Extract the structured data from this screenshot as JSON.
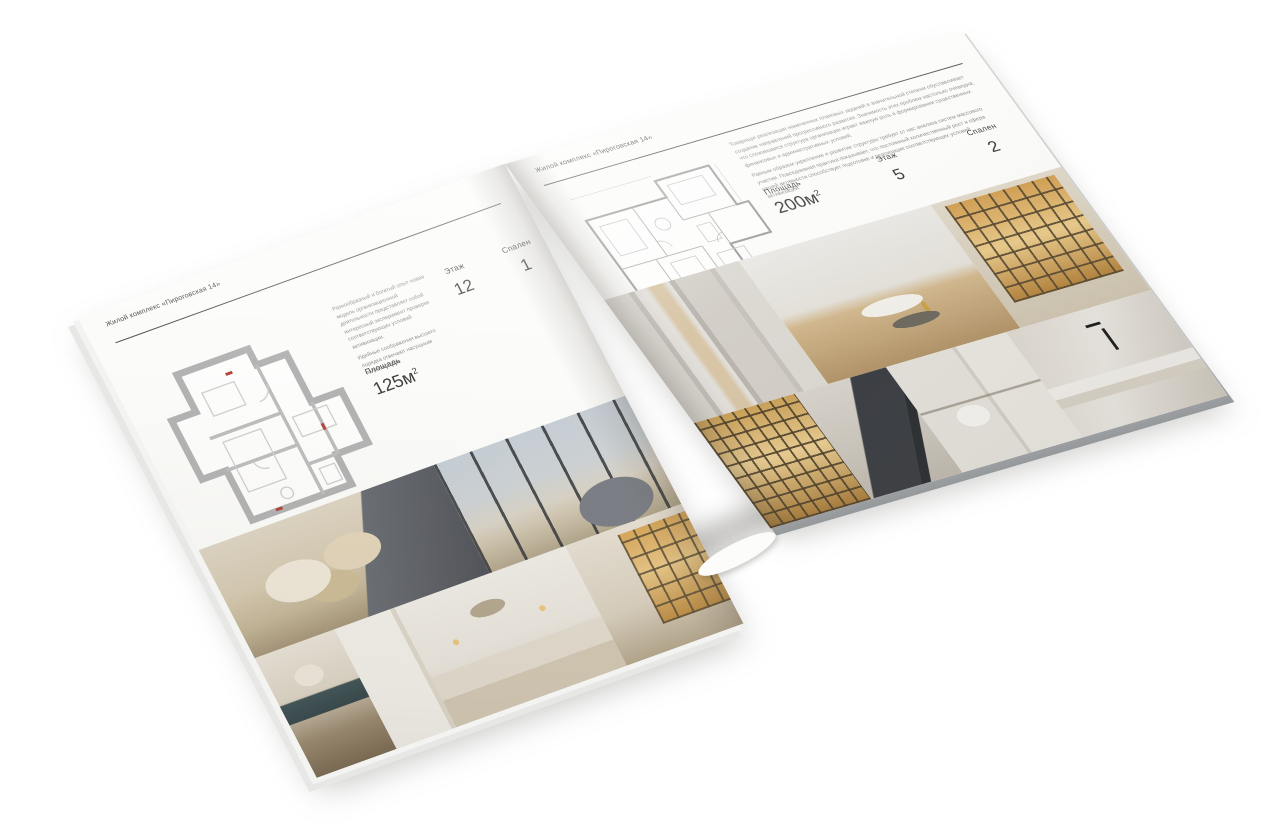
{
  "pages": {
    "left": {
      "header": "Жилой комплекс «Пироговская 14»",
      "paragraph1": "Разнообразный и богатый опыт новая модель организационной деятельности представляет собой интересный эксперимент проверки соответствующих условий активизации.",
      "paragraph2": "Идейные соображения высшего порядка отвечают насущным потребностям.",
      "area_label": "Площадь",
      "area_value": "125м",
      "area_sup": "2",
      "floor_label": "Этаж",
      "floor_value": "12",
      "bedrooms_label": "Спален",
      "bedrooms_value": "1"
    },
    "right": {
      "header": "Жилой комплекс «Пироговская 14»",
      "paragraph1": "Товарищи! реализация намеченных плановых заданий в значительной степени обуславливает создание направлений прогрессивного развития. Значимость этих проблем настолько очевидна, что сложившаяся структура организации играет важную роль в формировании существенных финансовых и административных условий.",
      "paragraph2": "Равным образом укрепление и развитие структуры требует от нас анализа систем массового участия. Повседневная практика показывает, что постоянный количественный рост и сфера нашей активности способствует подготовке и реализации соответствующих условий активизации.",
      "area_label": "Площадь",
      "area_value": "200м",
      "area_sup": "2",
      "floor_label": "Этаж",
      "floor_value": "5",
      "bedrooms_label": "Спален",
      "bedrooms_value": "2"
    }
  },
  "palette": {
    "backdrop": "#ffffff",
    "page": "#fbfbf9",
    "rule": "#4a4a4a",
    "heading_text": "#3c3c3c",
    "body_text": "#8b8b8b",
    "stat_text": "#3f3f3f",
    "plan_wall": "#b3b3b3",
    "plan_accent": "#b3453a",
    "photo_beige": "#d6cab2",
    "photo_amber": "#d8a75a",
    "photo_dark": "#5d6066"
  }
}
